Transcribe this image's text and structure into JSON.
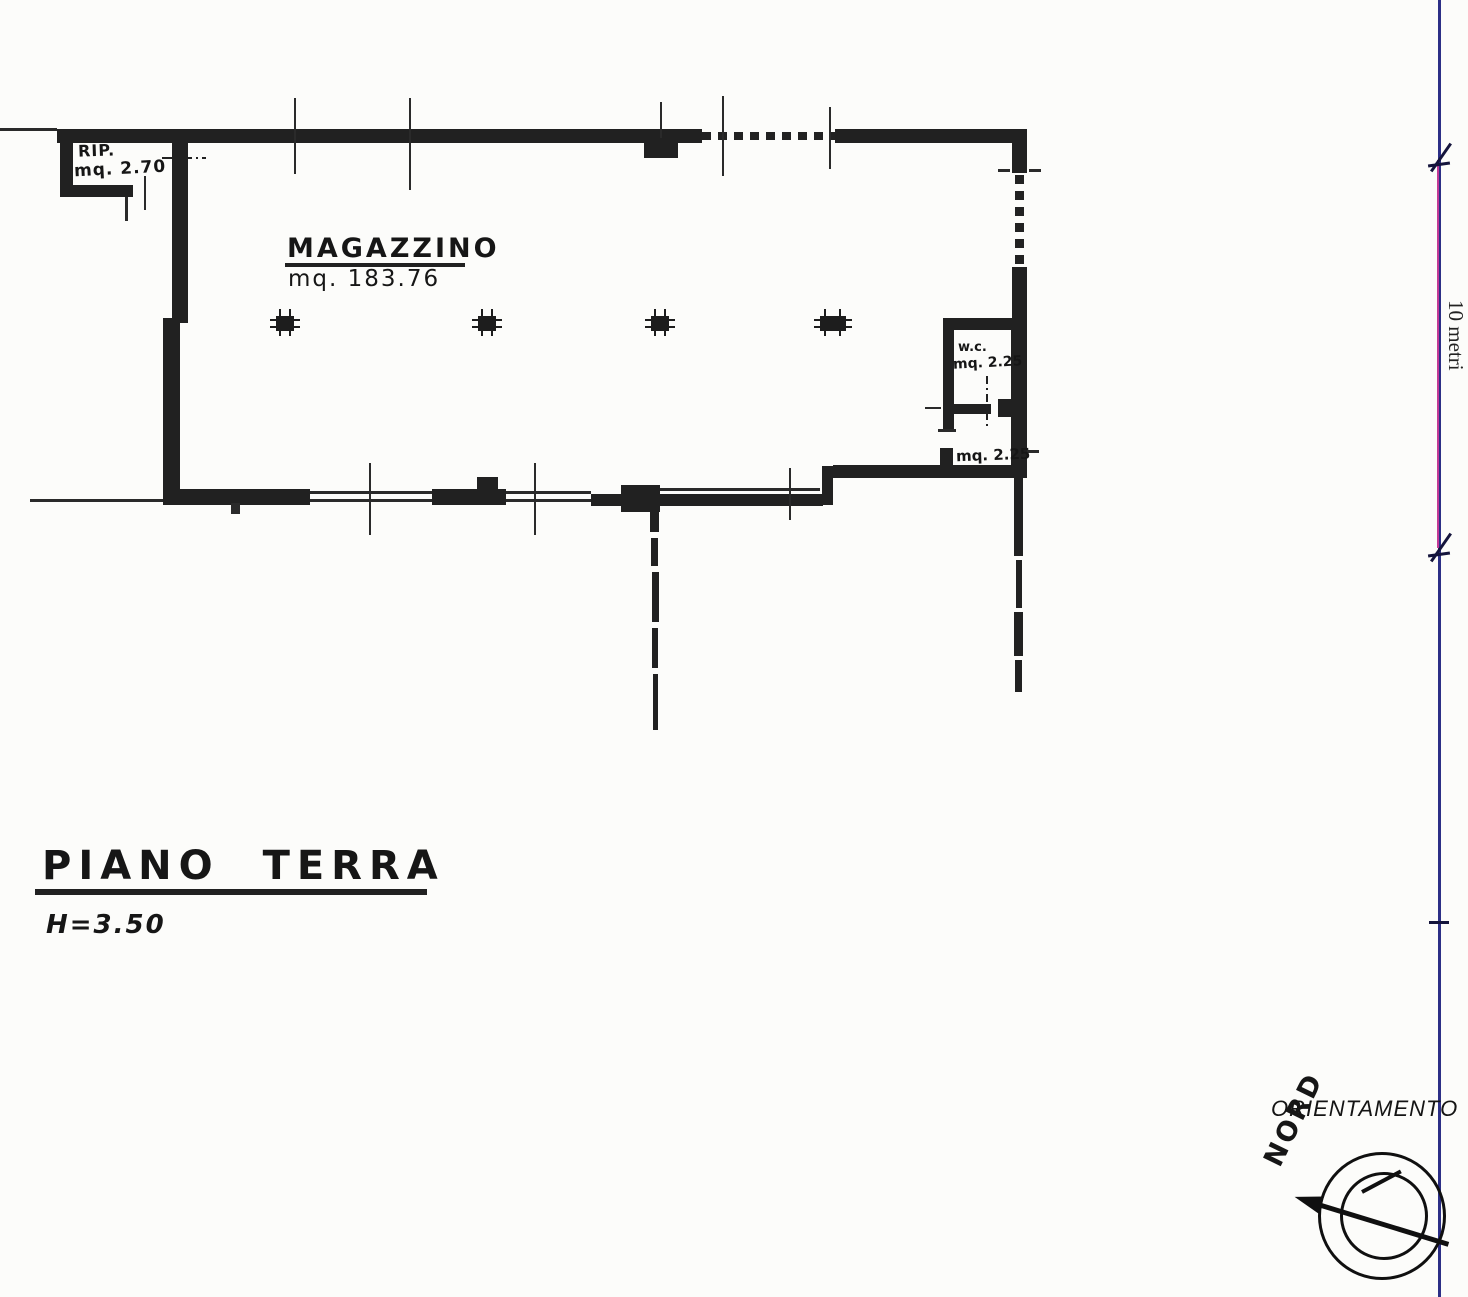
{
  "document": {
    "type": "scanned floor plan",
    "floor_title": "PIANO TERRA",
    "ceiling_height": "H=3.50"
  },
  "rooms": {
    "rip": {
      "name": "RIP.",
      "area": "mq. 2.70"
    },
    "magazzino": {
      "name": "MAGAZZINO",
      "area": "mq. 183.76"
    },
    "wc": {
      "name": "w.c.",
      "area": "mq. 2.25"
    },
    "storage_lower": {
      "area": "mq. 2.25"
    }
  },
  "scale_bar": {
    "label": "10 metri"
  },
  "compass": {
    "heading_label": "ORIENTAMENTO",
    "north_label": "NORD"
  },
  "colors": {
    "wall": "#212121",
    "paper": "#fcfcfa",
    "scale_line_blue": "#2c2f86",
    "scale_line_magenta": "#c23a96"
  }
}
